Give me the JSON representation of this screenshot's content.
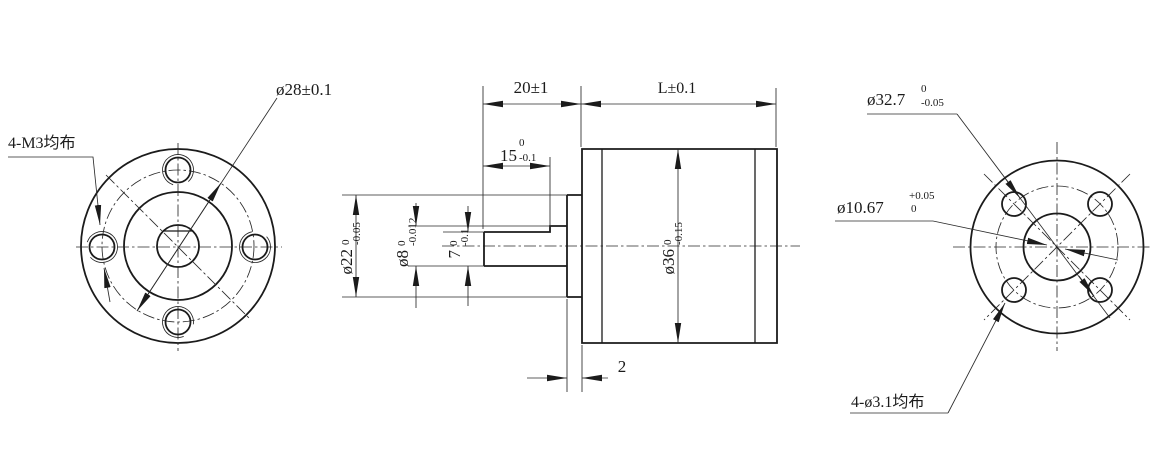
{
  "drawing": {
    "background": "#ffffff",
    "line_color": "#1b1b1b",
    "front_view": {
      "hole_callout": "4-M3均布",
      "bolt_circle_dim": "ø28±0.1"
    },
    "side_view": {
      "shaft_extension_dim": "20±1",
      "body_length_dim": "L±0.1",
      "flat_length": {
        "main": "15",
        "tol_top": "0",
        "tol_bot": "-0.1"
      },
      "pilot_diameter": {
        "main": "ø22",
        "tol_top": "0",
        "tol_bot": "-0.05"
      },
      "shaft_diameter": {
        "main": "ø8",
        "tol_top": "0",
        "tol_bot": "-0.012"
      },
      "flat_height": {
        "main": "7",
        "tol_top": "0",
        "tol_bot": "-0.1"
      },
      "body_diameter": {
        "main": "ø36",
        "tol_top": "0",
        "tol_bot": "-0.15"
      },
      "boss_thickness_dim": "2"
    },
    "rear_view": {
      "spigot_diameter": {
        "main": "ø32.7",
        "tol_top": "0",
        "tol_bot": "-0.05"
      },
      "center_diameter": {
        "main": "ø10.67",
        "tol_top": "+0.05",
        "tol_bot": "0"
      },
      "hole_callout": "4-ø3.1均布"
    }
  }
}
